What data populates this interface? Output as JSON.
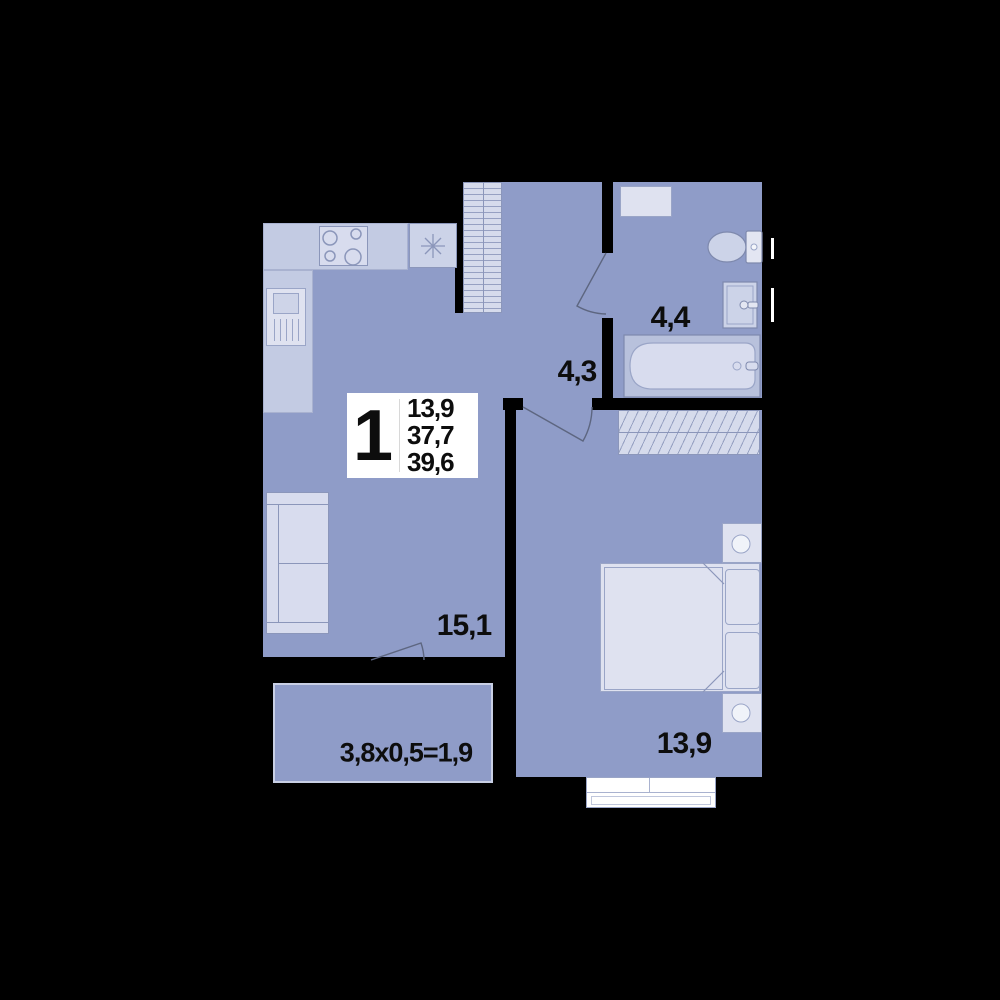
{
  "plan": {
    "title": "1-room apartment floor plan",
    "unit_box": {
      "rooms_count": "1",
      "living_area": "13,9",
      "area_without_balcony": "37,7",
      "total_area": "39,6"
    },
    "room_labels": {
      "kitchen_living": "15,1",
      "hallway": "4,3",
      "bathroom": "4,4",
      "bedroom": "13,9",
      "balcony": "3,8x0,5=1,9"
    },
    "palette": {
      "background": "#000000",
      "floor": "#8f9cc8",
      "furniture_light": "#d8dcee",
      "counter": "#c3cbe3",
      "fixture": "#ccd3e8",
      "tub_rim": "#b8c1dc",
      "line": "#8b96ba",
      "door_line": "#5d6680",
      "label_box": "#ffffff",
      "text": "#0d0d0d"
    }
  }
}
